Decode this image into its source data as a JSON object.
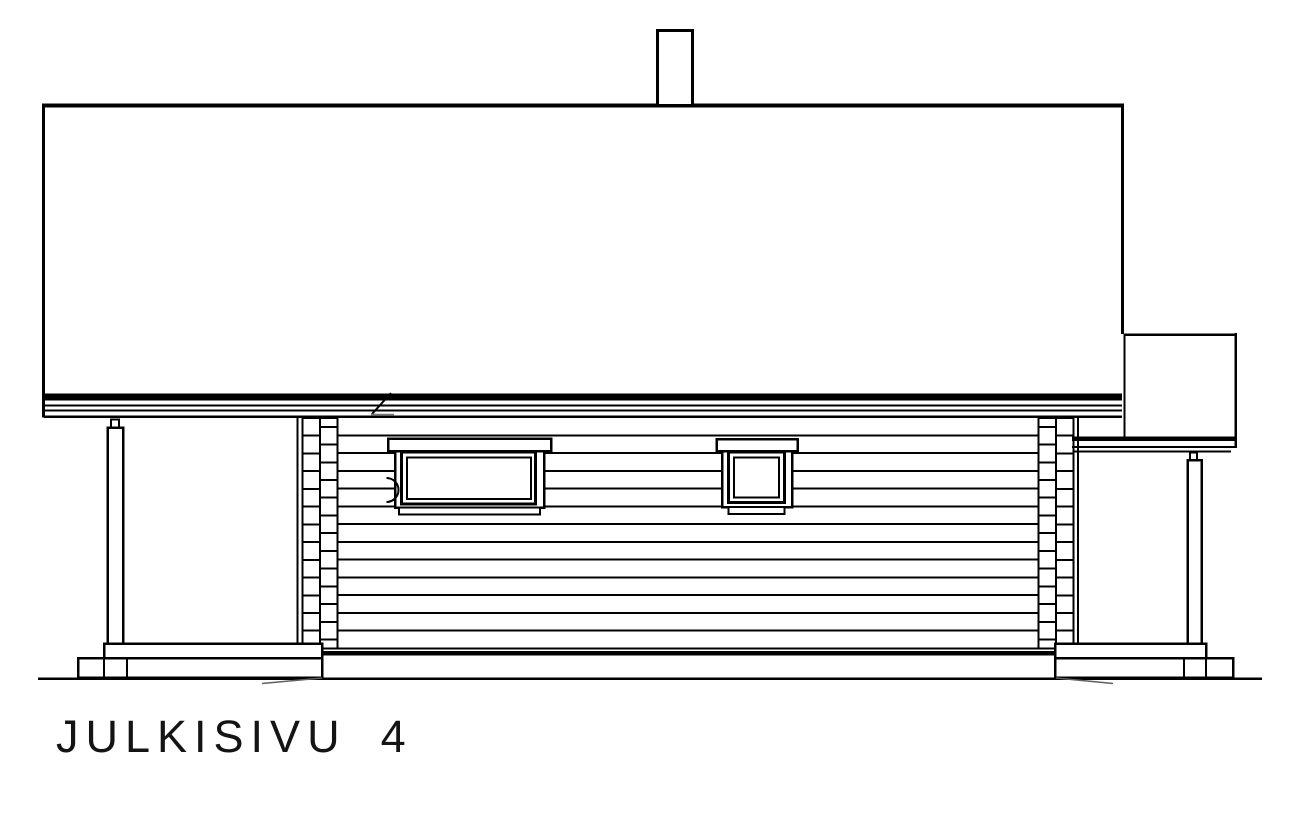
{
  "title": {
    "label": "JULKISIVU",
    "number": "4",
    "full_text": "JULKISIVU 4"
  },
  "colors": {
    "background": "#ffffff",
    "ink": "#000000",
    "hatch_gray": "#5f5f5f"
  },
  "construction": {
    "wall_log_lines": {
      "count": 13,
      "first_y": 435.5,
      "spacing": 17.73,
      "x1": 338,
      "x2": 1038
    },
    "corner_left": {
      "outer_line_x": 297.5,
      "colA_x": 302.5,
      "colB_x": 320,
      "col_w": 17.5,
      "top": 418,
      "bottom": 648.5,
      "aligned_start": 435.7,
      "offset_start": 426.8
    },
    "corner_right": {
      "outer_line_x": 1078,
      "colA_x": 1038.5,
      "colB_x": 1056,
      "col_w": 17.5,
      "top": 418,
      "bottom": 648.5,
      "aligned_start": 435.7,
      "offset_start": 426.8
    },
    "divider_step": 17.73,
    "divider_limit_y": 646
  }
}
